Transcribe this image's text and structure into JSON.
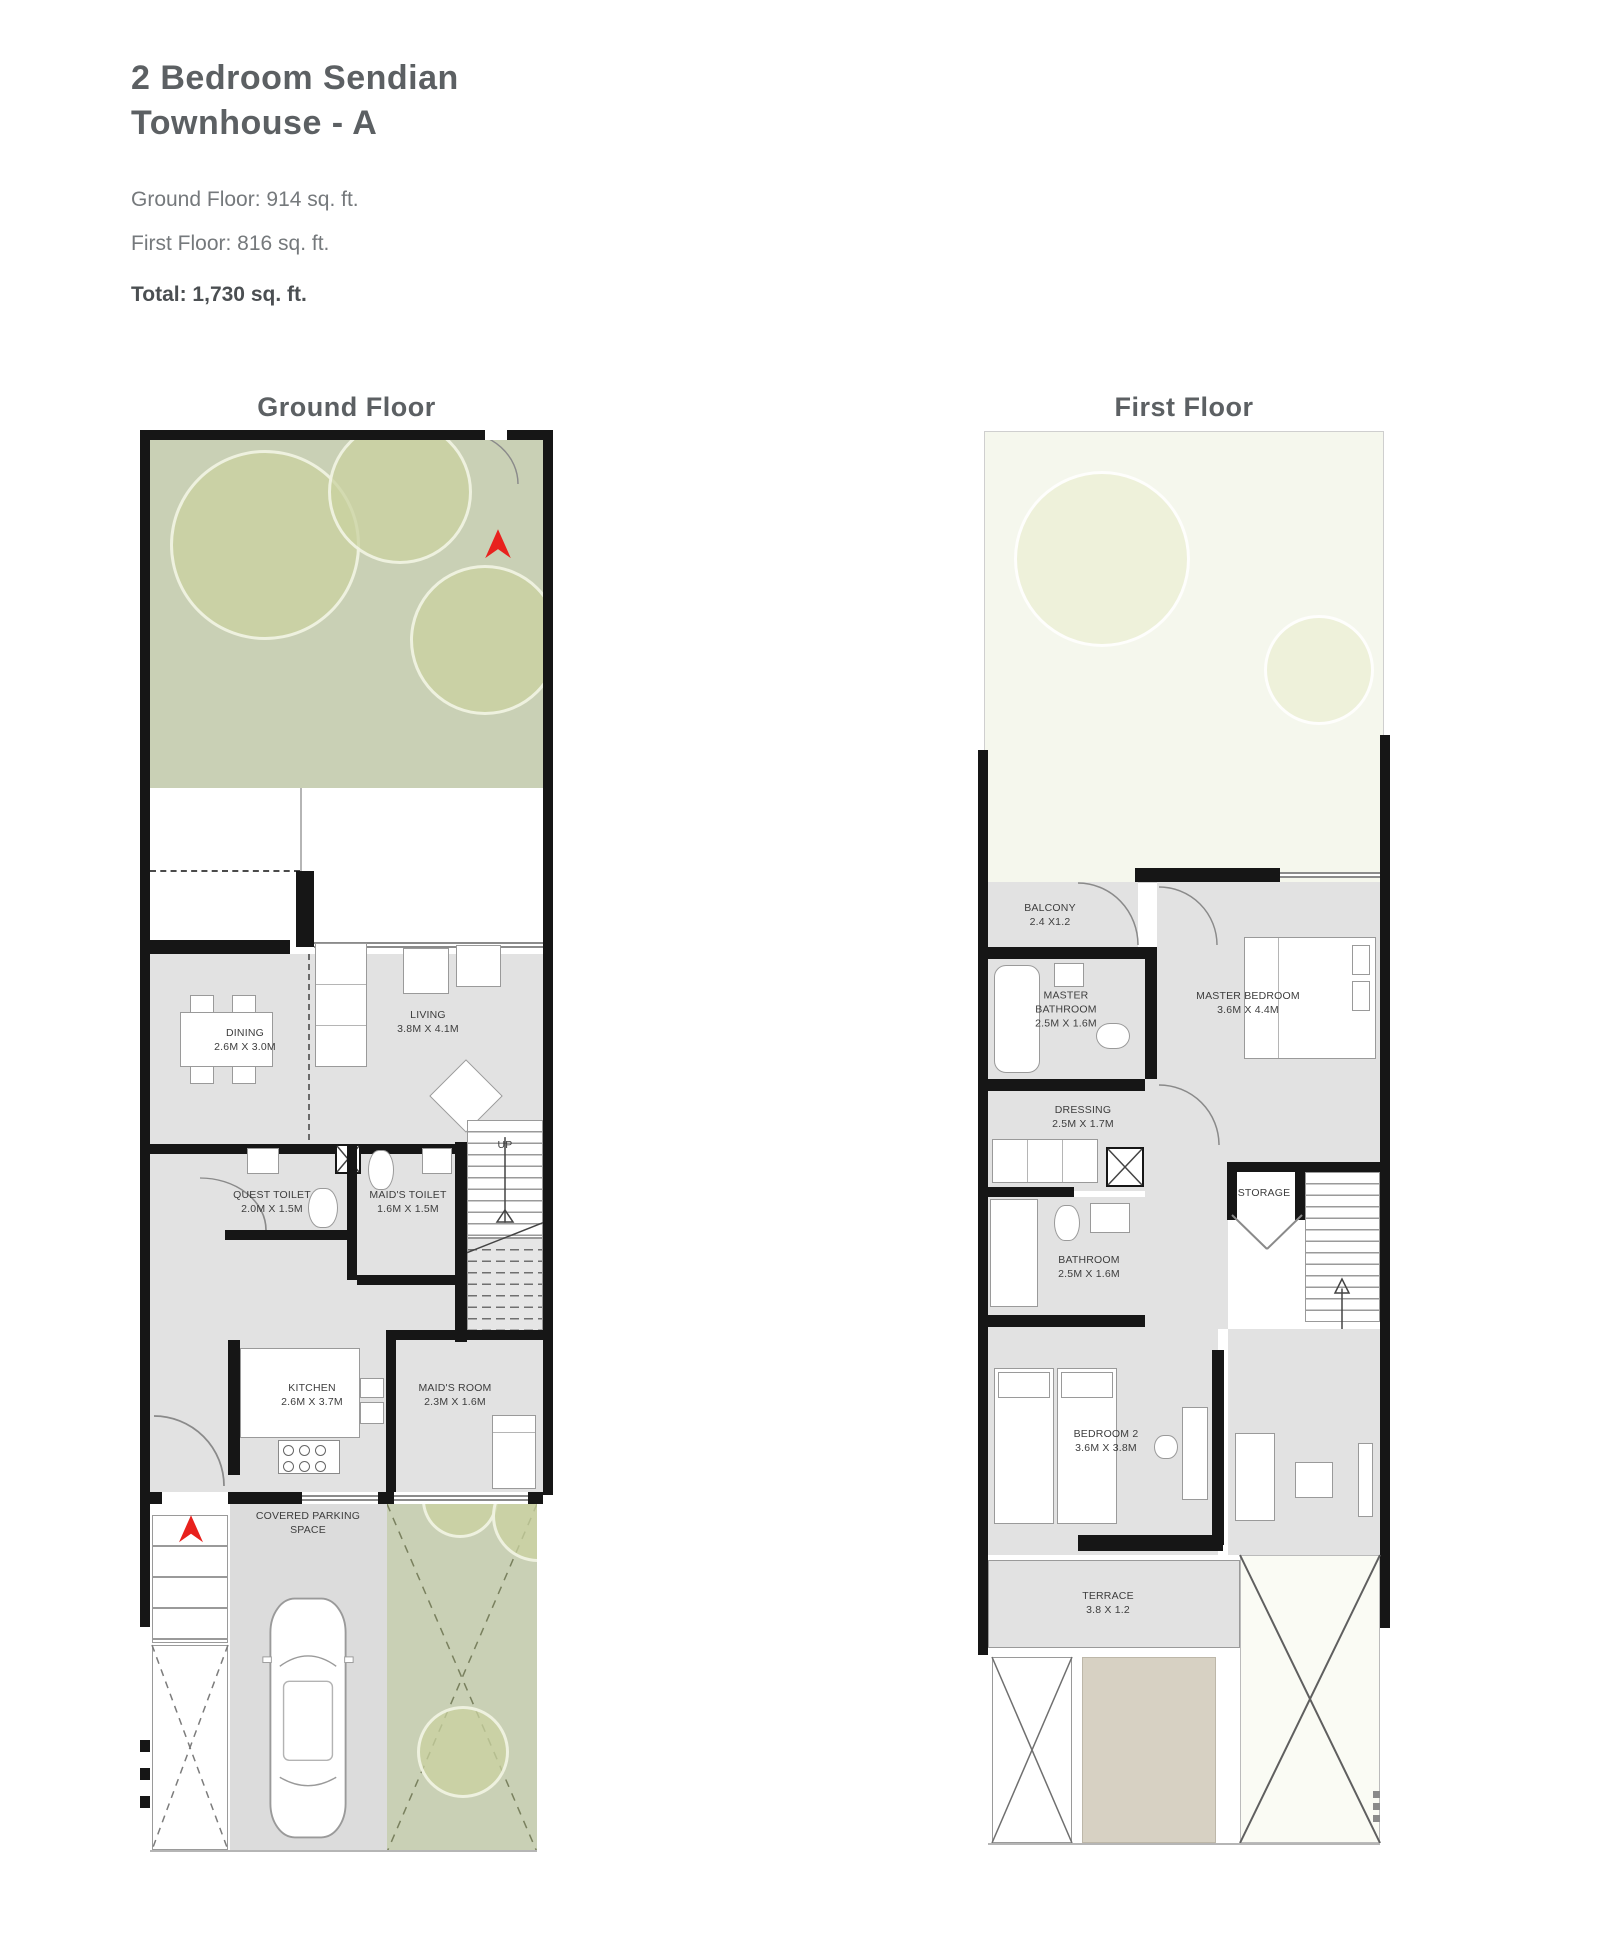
{
  "header": {
    "title_line1": "2 Bedroom Sendian",
    "title_line2": "Townhouse - A",
    "ground_floor_area": "Ground Floor: 914 sq. ft.",
    "first_floor_area": "First Floor: 816 sq. ft.",
    "total_area": "Total: 1,730 sq. ft."
  },
  "ground_floor": {
    "title": "Ground Floor",
    "labels": {
      "dining": {
        "name": "DINING",
        "dim": "2.6M X 3.0M"
      },
      "living": {
        "name": "LIVING",
        "dim": "3.8M X 4.1M"
      },
      "quest_toilet": {
        "name": "QUEST TOILET",
        "dim": "2.0M X 1.5M"
      },
      "maids_toilet": {
        "name": "MAID'S TOILET",
        "dim": "1.6M X 1.5M"
      },
      "stairs_up": "UP",
      "kitchen": {
        "name": "KITCHEN",
        "dim": "2.6M X 3.7M"
      },
      "maids_room": {
        "name": "MAID'S ROOM",
        "dim": "2.3M X 1.6M"
      },
      "parking": {
        "name": "COVERED PARKING SPACE"
      }
    }
  },
  "first_floor": {
    "title": "First Floor",
    "labels": {
      "balcony": {
        "name": "BALCONY",
        "dim": "2.4 X1.2"
      },
      "master_bathroom": {
        "name": "MASTER BATHROOM",
        "dim": "2.5M X 1.6M"
      },
      "master_bedroom": {
        "name": "MASTER BEDROOM",
        "dim": "3.6M X 4.4M"
      },
      "dressing": {
        "name": "DRESSING",
        "dim": "2.5M X 1.7M"
      },
      "storage": {
        "name": "STORAGE"
      },
      "bathroom": {
        "name": "BATHROOM",
        "dim": "2.5M X 1.6M"
      },
      "bedroom_2": {
        "name": "BEDROOM 2",
        "dim": "3.6M X 3.8M"
      },
      "landing": {
        "name": "LANDING",
        "dim": "2.5M X 2.6M"
      },
      "terrace": {
        "name": "TERRACE",
        "dim": "3.8 X 1.2"
      }
    }
  },
  "colors": {
    "accent_red": "#e8211d",
    "wall": "#161616",
    "garden_green": "#c9d0b5",
    "floor_gray": "#e2e2e2",
    "roof_beige": "#d7d1c3"
  }
}
